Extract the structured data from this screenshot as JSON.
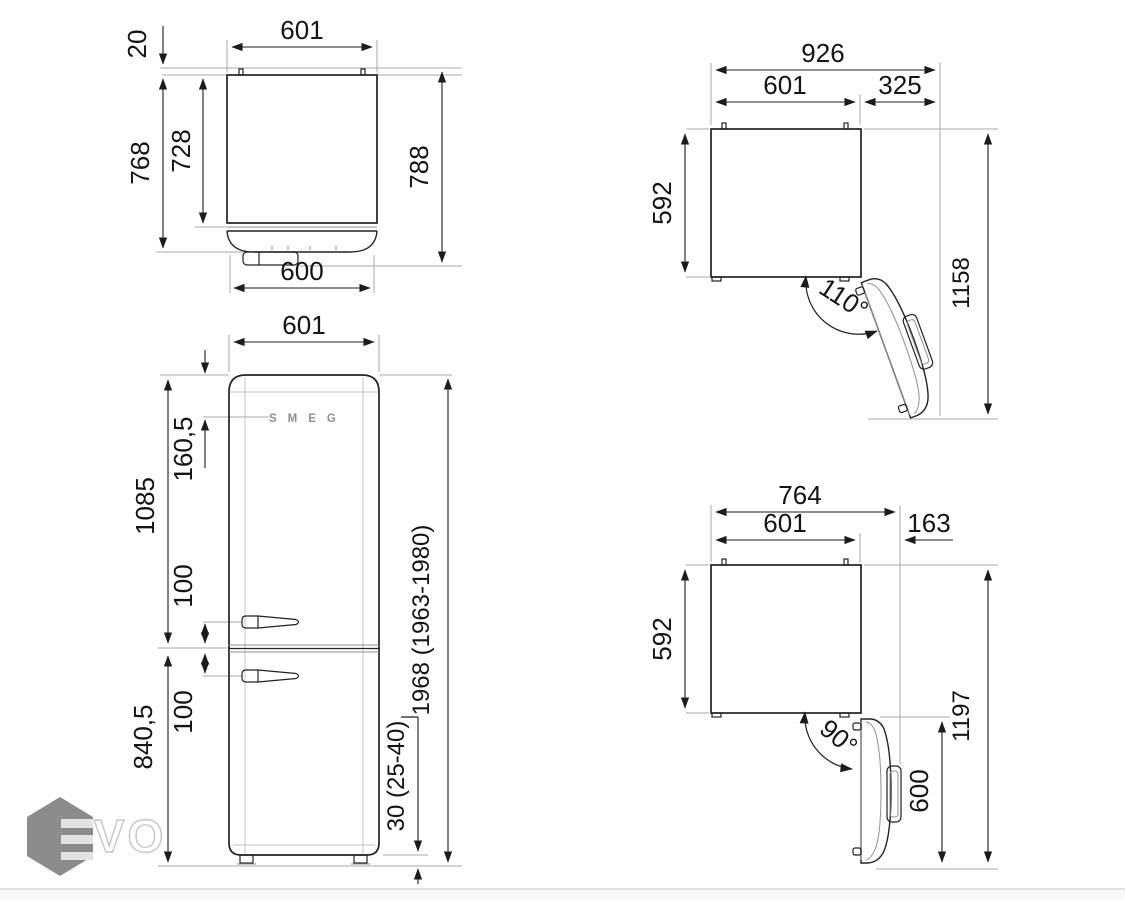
{
  "watermark": {
    "text": "VO"
  },
  "views": {
    "plan_closed": {
      "name": "top view door closed",
      "dims": {
        "width_top": "601",
        "wall_gap": "20",
        "depth_with_door": "768",
        "depth_cabinet": "728",
        "depth_total": "788",
        "door_width": "600"
      }
    },
    "front": {
      "name": "front view",
      "logo": "SMEG",
      "dims": {
        "width": "601",
        "logo_offset": "160,5",
        "fridge_section": "1085",
        "handle_offset_upper": "100",
        "handle_offset_lower": "100",
        "freezer_section": "840,5",
        "height": "1968 (1963-1980)",
        "feet_height": "30 (25-40)"
      }
    },
    "plan_open_110": {
      "name": "top view door open 110",
      "dims": {
        "total_width": "926",
        "width": "601",
        "door_swing": "325",
        "depth": "592",
        "angle": "110°",
        "total_depth": "1158"
      }
    },
    "plan_open_90": {
      "name": "top view door open 90",
      "dims": {
        "total_width": "764",
        "width": "601",
        "door_swing": "163",
        "depth": "592",
        "angle": "90°",
        "door_width": "600",
        "total_depth": "1197"
      }
    }
  }
}
